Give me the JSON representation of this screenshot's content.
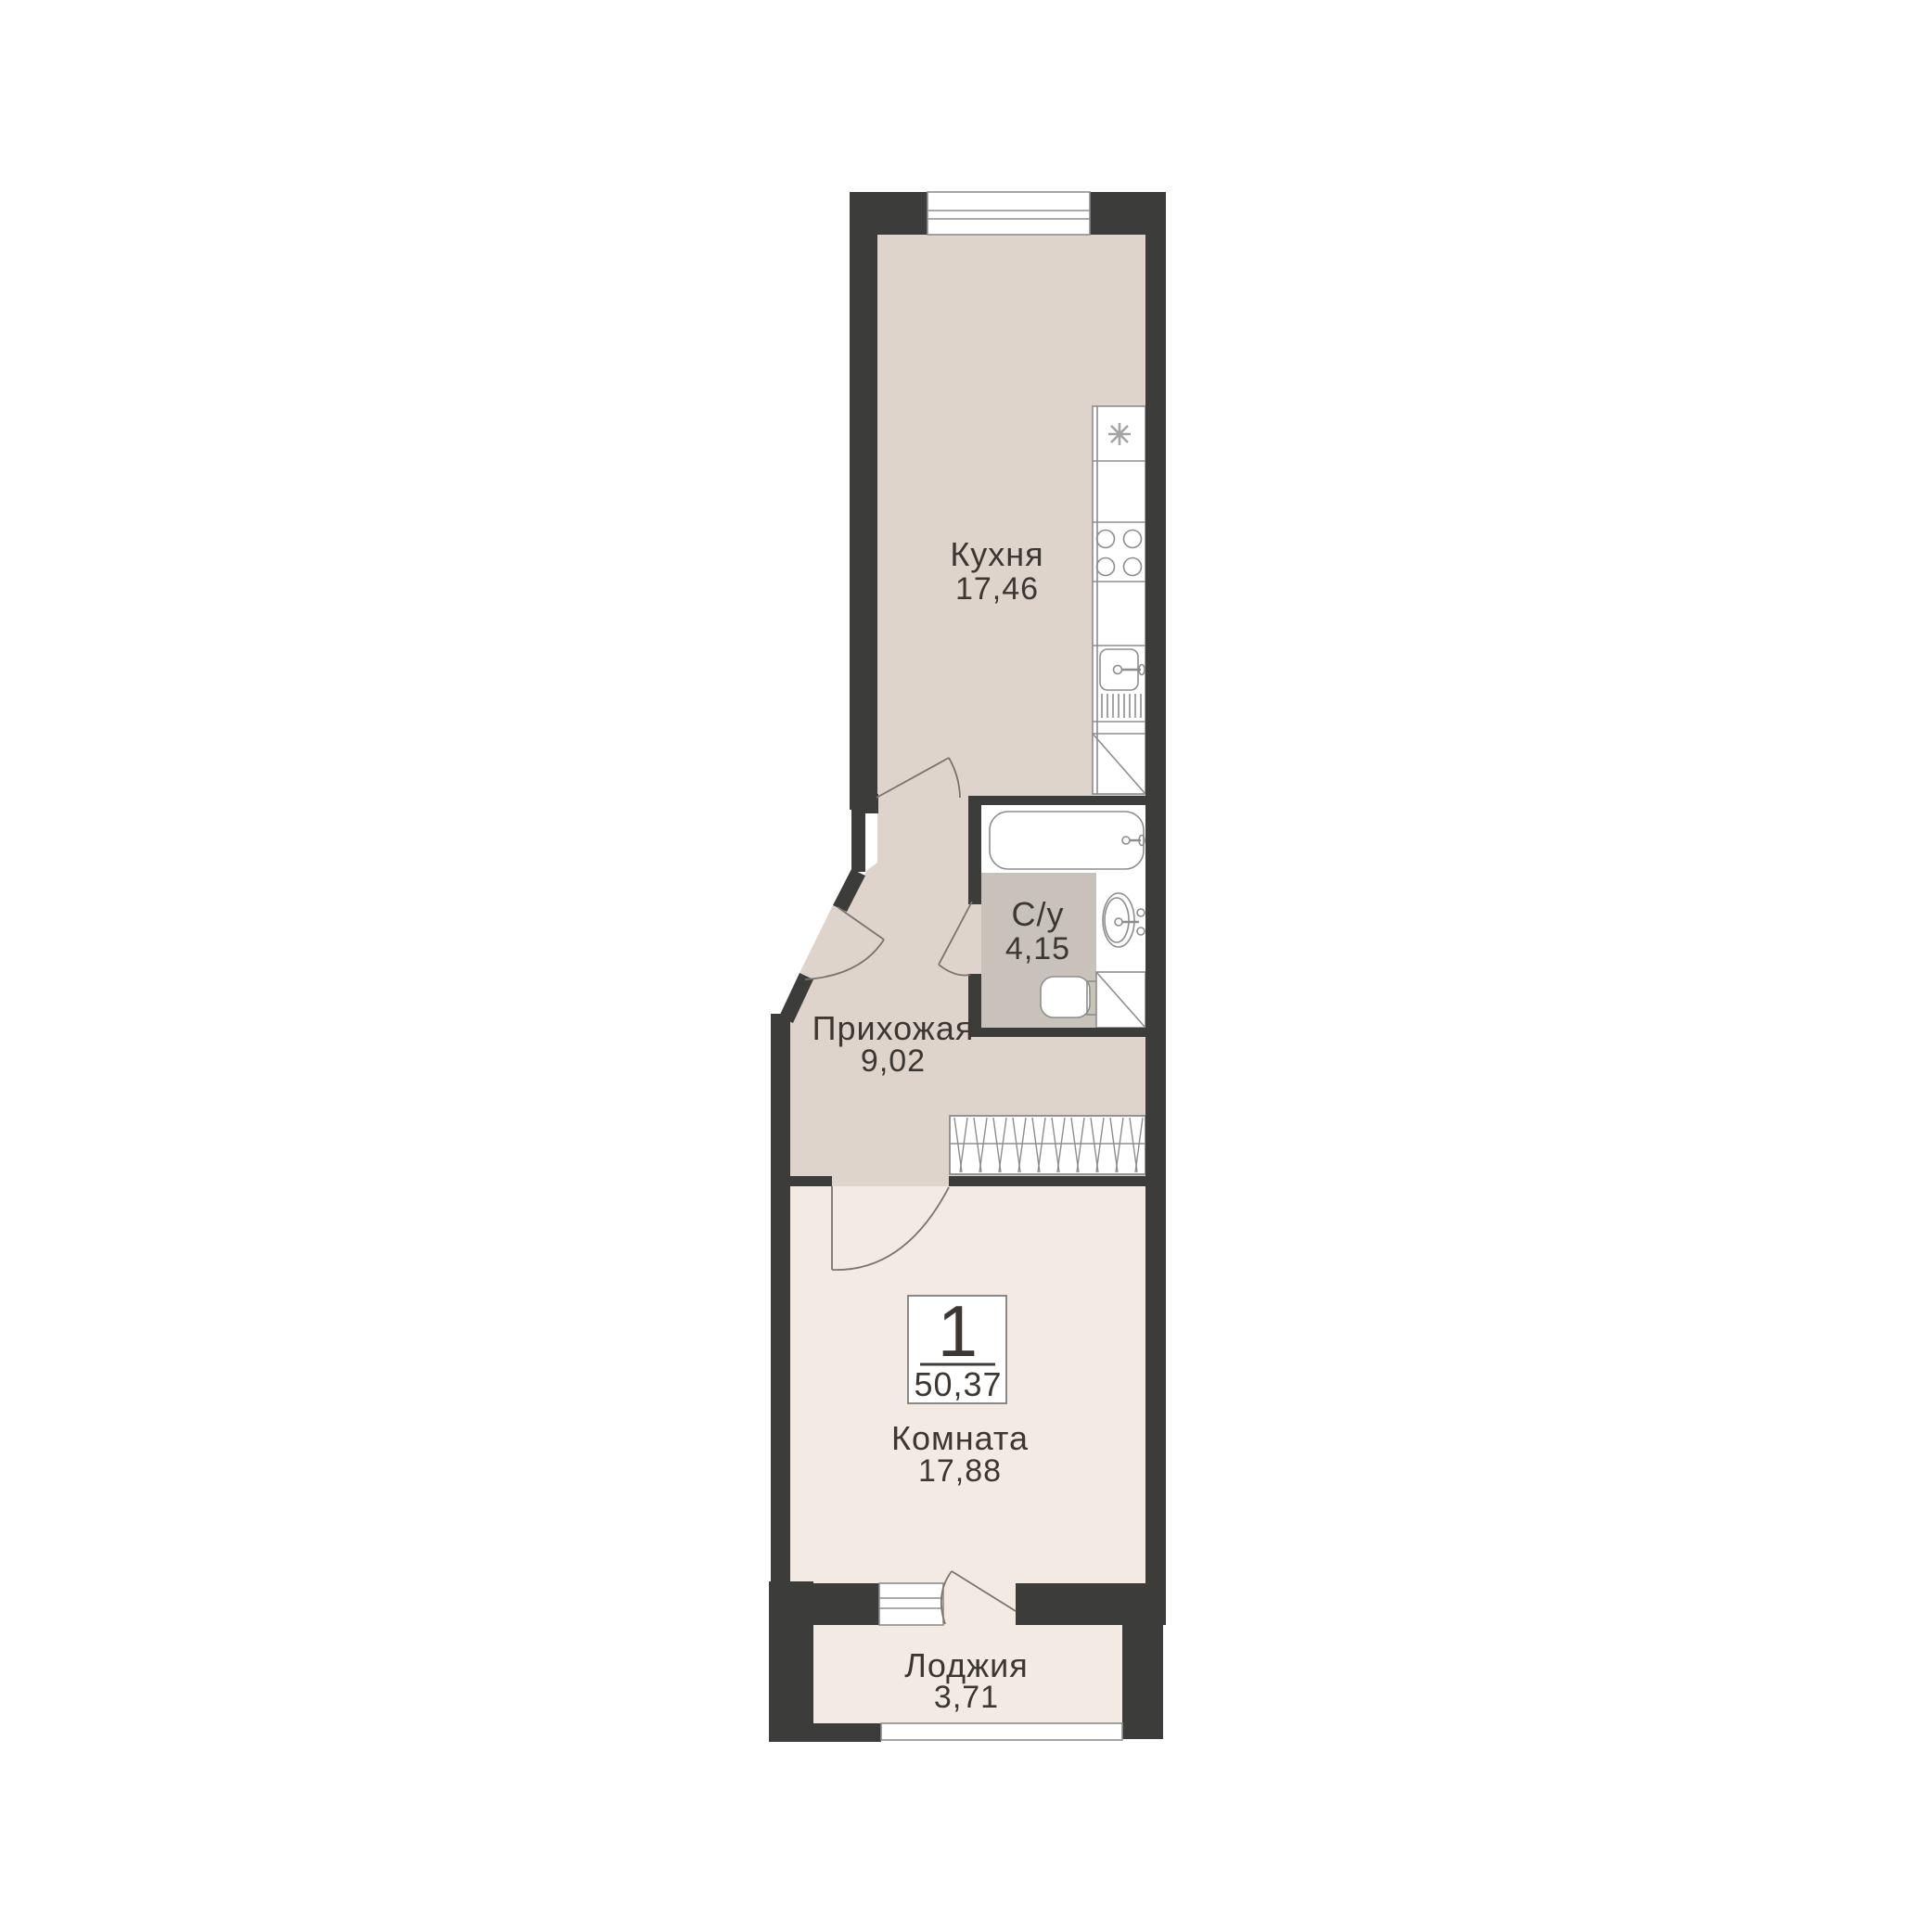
{
  "plan_title": "Floor plan of 1-room apartment",
  "badge": {
    "rooms_count": "1",
    "total_area": "50,37"
  },
  "rooms": [
    {
      "key": "kitchen",
      "label": "Кухня",
      "area": "17,46"
    },
    {
      "key": "bathroom",
      "label": "С/у",
      "area": "4,15"
    },
    {
      "key": "hallway",
      "label": "Прихожая",
      "area": "9,02"
    },
    {
      "key": "room",
      "label": "Комната",
      "area": "17,88"
    },
    {
      "key": "loggia",
      "label": "Лоджия",
      "area": "3,71"
    }
  ],
  "colors": {
    "wall": "#3c3c3b",
    "floor_kitchen_hall": "#ded4cb",
    "floor_bathroom": "#c9c2ba",
    "floor_room_loggia": "#f3eae3",
    "fixture_line": "#8d8d8d",
    "text": "#3c3733"
  },
  "fixtures": [
    "refrigerator-spot",
    "cooktop-4-burner",
    "kitchen-sink",
    "dish-drainer",
    "corner-cabinet",
    "bathtub",
    "wash-basin",
    "toilet",
    "duct",
    "wardrobe",
    "entrance-door",
    "kitchen-door",
    "bathroom-door",
    "room-door",
    "balcony-door",
    "window-top",
    "window-room",
    "window-loggia"
  ]
}
